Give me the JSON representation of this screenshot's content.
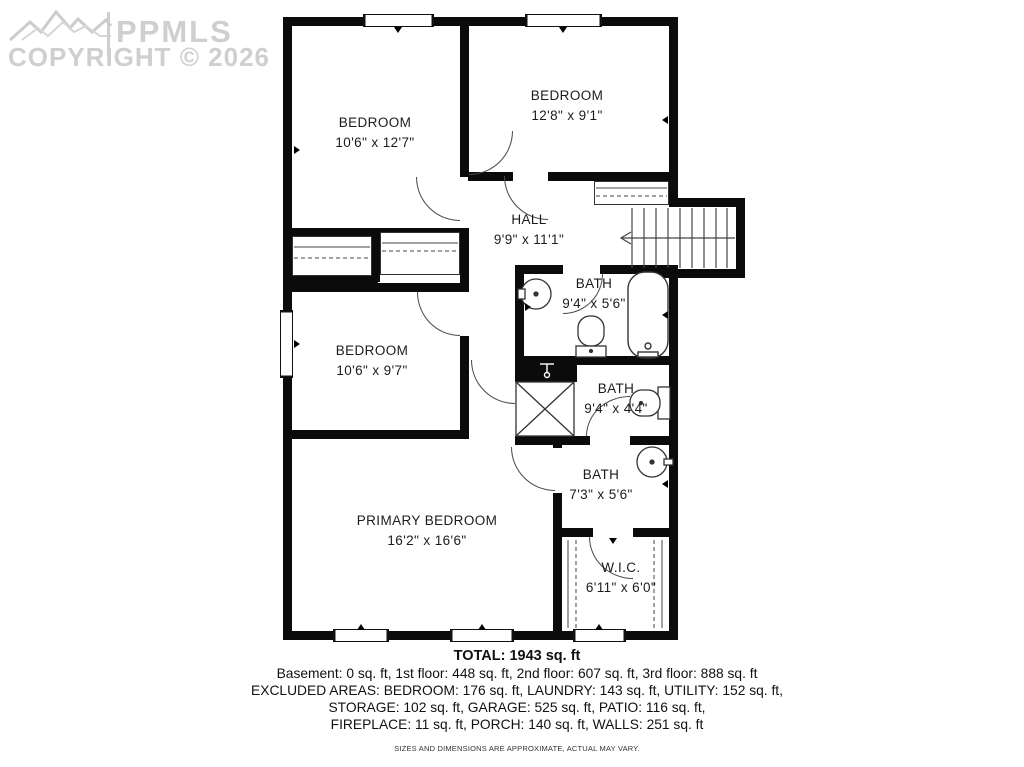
{
  "watermark": {
    "brand": "PPMLS",
    "copyright": "COPYRIGHT © 2026"
  },
  "rooms": [
    {
      "name": "BEDROOM",
      "dims": "10'6\" x 12'7\""
    },
    {
      "name": "BEDROOM",
      "dims": "12'8\" x 9'1\""
    },
    {
      "name": "HALL",
      "dims": "9'9\" x 11'1\""
    },
    {
      "name": "BATH",
      "dims": "9'4\" x 5'6\""
    },
    {
      "name": "BEDROOM",
      "dims": "10'6\" x 9'7\""
    },
    {
      "name": "BATH",
      "dims": "9'4\" x 4'4\""
    },
    {
      "name": "BATH",
      "dims": "7'3\" x 5'6\""
    },
    {
      "name": "PRIMARY BEDROOM",
      "dims": "16'2\" x 16'6\""
    },
    {
      "name": "W.I.C.",
      "dims": "6'11\" x 6'0\""
    }
  ],
  "footer": {
    "total": "TOTAL: 1943 sq. ft",
    "line1": "Basement: 0 sq. ft, 1st floor: 448 sq. ft, 2nd floor: 607 sq. ft, 3rd floor: 888 sq. ft",
    "line2": "EXCLUDED AREAS: BEDROOM: 176 sq. ft, LAUNDRY: 143 sq. ft, UTILITY: 152 sq. ft,",
    "line3": "STORAGE: 102 sq. ft, GARAGE: 525 sq. ft, PATIO: 116 sq. ft,",
    "line4": "FIREPLACE: 11 sq. ft, PORCH: 140 sq. ft, WALLS: 251 sq. ft",
    "disclaimer": "SIZES AND DIMENSIONS ARE APPROXIMATE, ACTUAL MAY VARY."
  }
}
